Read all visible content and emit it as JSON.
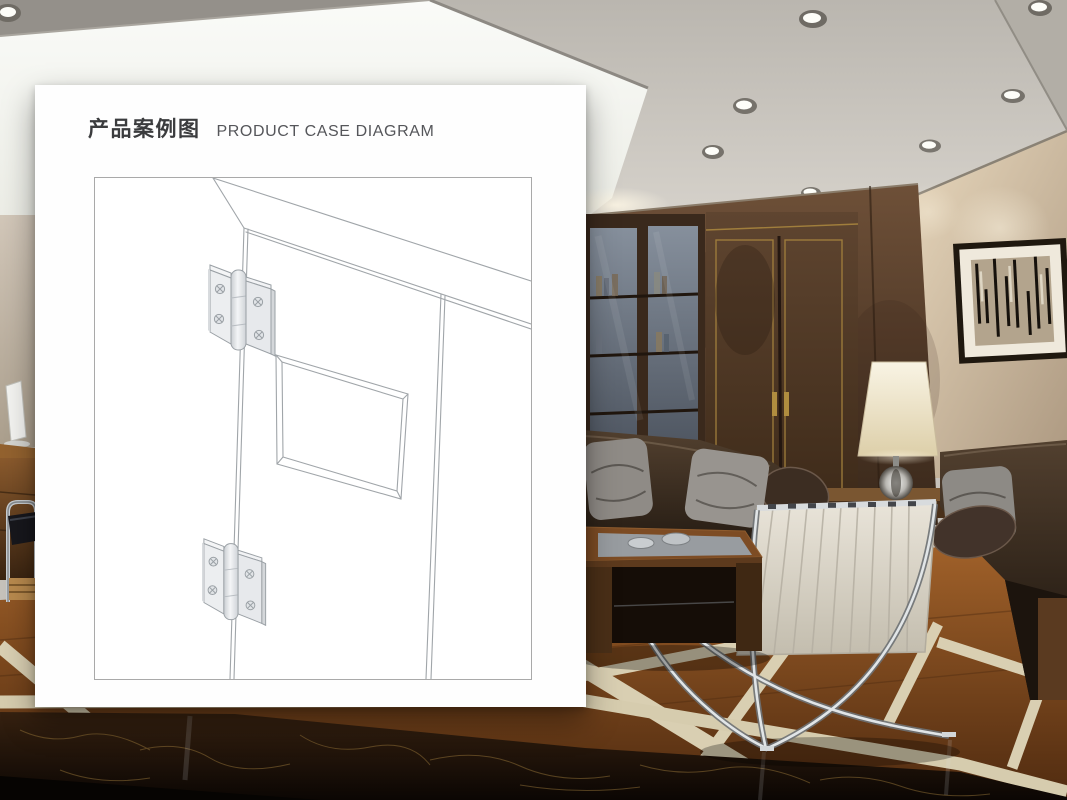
{
  "card": {
    "title_zh": "产品案例图",
    "title_en": "PRODUCT CASE DIAGRAM"
  },
  "diagram": {
    "type": "line-drawing",
    "subject": "interior door shown in perspective with two butt hinges mounted on the left stile and a recessed vision panel",
    "elements": [
      "diagram-border",
      "wall-top-edge",
      "door-leaf-outline",
      "vision-panel",
      "top-hinge",
      "bottom-hinge",
      "hinge-pin-line"
    ],
    "line_color": "#a0a5a9",
    "hinge_fill": "#eceef0"
  },
  "background": {
    "scene": "luxury office lounge photograph",
    "colors": {
      "ceiling": "#c6c2bb",
      "light_panel": "#f8f9f6",
      "wood_wall": "#5a4130",
      "beige_wall": "#d4c6b1",
      "gold_trim": "#a8853e",
      "sofa_leather": "#31261e",
      "pillow_gray": "#8b8783",
      "chair_leather": "#ddd8cd",
      "floor_wood": "#8a4f20",
      "floor_inlay": "#d9cfb2",
      "marble_dark": "#1c120a"
    }
  }
}
